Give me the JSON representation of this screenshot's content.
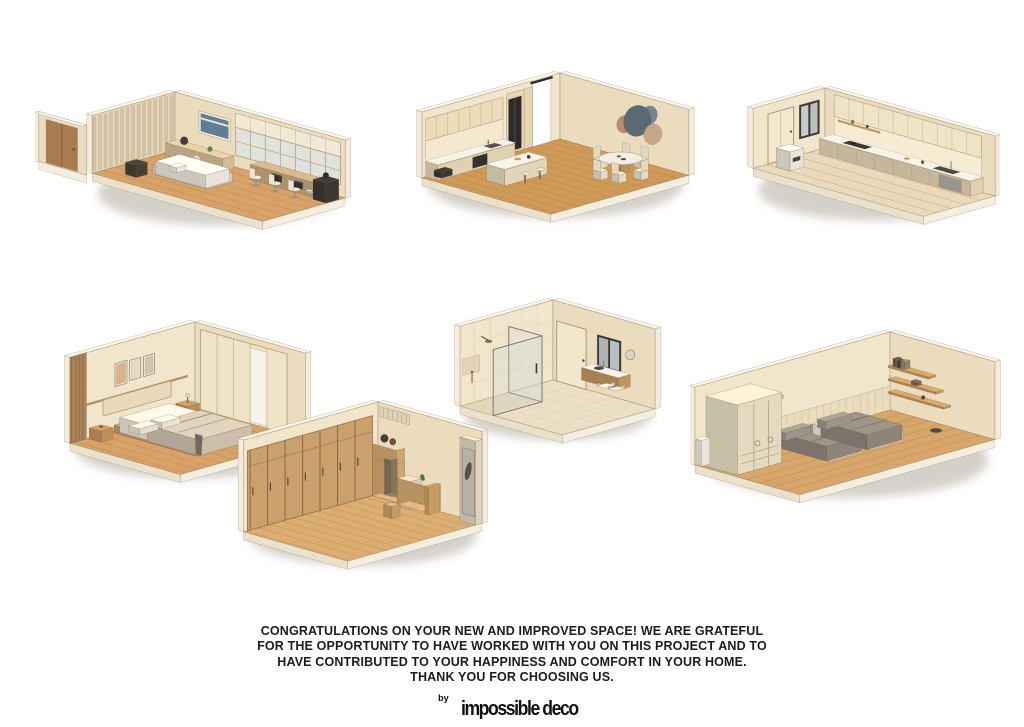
{
  "poster": {
    "message_lines": [
      "CONGRATULATIONS ON YOUR NEW AND IMPROVED SPACE! WE ARE GRATEFUL",
      "FOR THE OPPORTUNITY TO HAVE WORKED WITH YOU ON THIS PROJECT AND TO",
      "HAVE CONTRIBUTED TO YOUR HAPPINESS AND COMFORT IN YOUR HOME.",
      "THANK YOU FOR CHOOSING US."
    ],
    "brand": {
      "prefix": "by",
      "name": "impossible deco"
    },
    "renders": [
      {
        "name": "living-room-home-office",
        "description": "isometric cutaway with door, curtain wall, daybed, sideboard, glazed wall and double workstation with white chairs"
      },
      {
        "name": "kitchen-dining-room",
        "description": "isometric cutaway with cream kitchen run, black fridge, island with stools, round dining table with six chairs and circle wall decor"
      },
      {
        "name": "galley-kitchen",
        "description": "isometric cutaway with door, dark window, upper cabinets and counter run with sink and stove"
      },
      {
        "name": "master-bedroom",
        "description": "isometric cutaway with three framed artworks, upholstered headboard, platform bed, nightstands and built-in wardrobe"
      },
      {
        "name": "bathroom",
        "description": "isometric cutaway with glass shower enclosure, rain shower, door, dark window and floating wood vanity"
      },
      {
        "name": "entry-dressing-room",
        "description": "isometric cutaway with full-height wood wardrobe, open shelves with bags, desk, stool and mirror wing"
      },
      {
        "name": "twin-bedroom",
        "description": "isometric cutaway with two single beds in taupe bedding, corner shelving with books and tall wardrobe"
      }
    ],
    "palette": {
      "background": "#ffffff",
      "text": "#1c1c1c",
      "wall_light": "#f1e5cb",
      "wall_shade": "#eadcbd",
      "rim": "#faf6ec",
      "rim_side": "#f3ecdd",
      "slab_se": "#f4eee1",
      "slab_sw": "#eae1cd",
      "floor_wood": "#d6a268",
      "floor_wood_deep": "#cf9a58",
      "floor_pale": "#ead9ba",
      "plank": "#a97e48",
      "wood": "#c79a63",
      "wood_deep": "#a87c50",
      "dark": "#3a3733",
      "fridge": "#2c2b29",
      "white_furn": "#f2ede2",
      "cream_furn": "#e9dab8",
      "bedding": "#d3c6b2",
      "bedding_gray": "#948a7e",
      "curtain_a": "#d6c2a6",
      "curtain_b": "#c9b494",
      "art_blue": "#5f7d96",
      "circle_gray": "#5d6974",
      "circle_slate": "#76848f",
      "circle_terracotta": "#bd8973",
      "circle_tan": "#c5a78a",
      "glass": "rgba(205,218,216,0.28)",
      "shadow": "rgba(115,100,75,0.30)"
    }
  }
}
